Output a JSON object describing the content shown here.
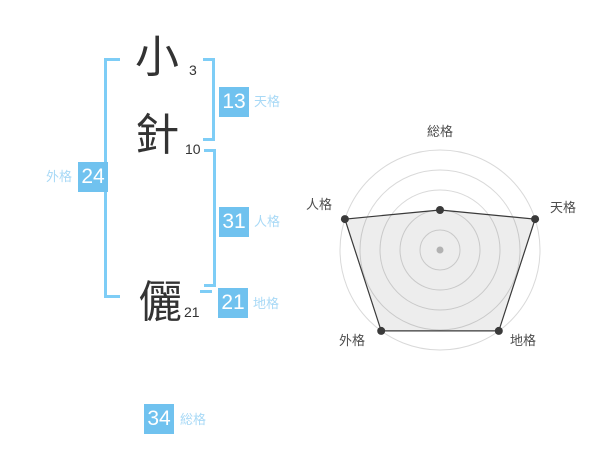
{
  "name": {
    "characters": [
      {
        "char": "小",
        "strokes": "3"
      },
      {
        "char": "針",
        "strokes": "10"
      },
      {
        "char": "儷",
        "strokes": "21"
      }
    ],
    "kaku": {
      "tenkaku": {
        "label": "天格",
        "value": "13"
      },
      "jinkaku": {
        "label": "人格",
        "value": "31"
      },
      "chikaku": {
        "label": "地格",
        "value": "21"
      },
      "gaikaku": {
        "label": "外格",
        "value": "24"
      },
      "soukaku": {
        "label": "総格",
        "value": "34"
      }
    }
  },
  "chart_data": {
    "type": "radar",
    "axes": [
      "総格",
      "天格",
      "地格",
      "外格",
      "人格"
    ],
    "values": [
      2,
      5,
      5,
      5,
      5
    ],
    "max": 5,
    "rings": 5,
    "legend": "none",
    "grid": "concentric-circles"
  },
  "colors": {
    "accent_blue": "#70c2ef",
    "bracket_blue": "#7ecdf6",
    "label_blue": "#a8d9f6",
    "ink": "#333333",
    "chart_ring": "#d9d9d9",
    "chart_line": "#3a3a3a",
    "chart_fill_alpha": 0.07,
    "chart_center_dot": "#c0c0c0",
    "chart_label": "#4d4d4d"
  }
}
